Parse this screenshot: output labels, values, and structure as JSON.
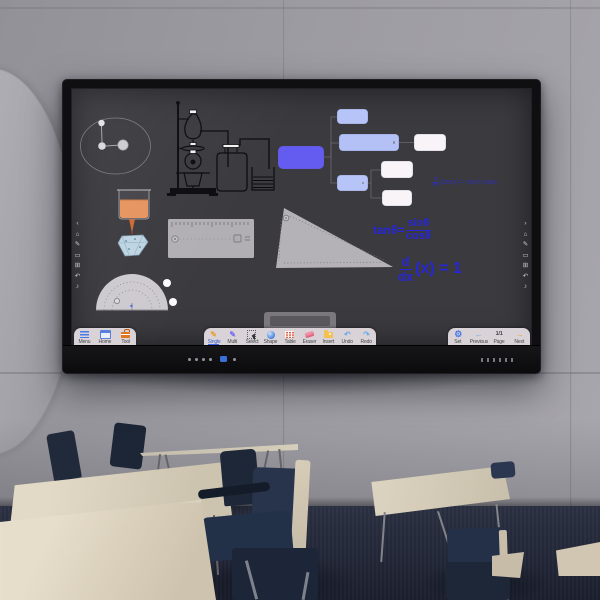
{
  "whiteboard": {
    "formulas": {
      "sec_derivative": {
        "num": "d",
        "den": "dx",
        "body": "(secx) = secx·tanx"
      },
      "tan_identity": {
        "lhs": "tanθ=",
        "num": "sinθ",
        "den": "cosθ"
      },
      "x_derivative": {
        "num": "d",
        "den": "dx",
        "body": "(x) = 1"
      }
    },
    "icon_glyphs": {
      "pen": "✎",
      "undo": "↶",
      "redo": "↷",
      "gear": "⚙",
      "arrow_left": "←",
      "arrow_right": "→"
    },
    "side_toolbar": {
      "left": [
        "‹",
        "⌂",
        "✎",
        "▭",
        "⊞",
        "↶",
        "♪"
      ],
      "right": [
        "›",
        "⌂",
        "✎",
        "▭",
        "⊞",
        "↶",
        "♪"
      ]
    },
    "docks": {
      "left": [
        {
          "label": "Menu",
          "icon": "hamburger-menu-icon"
        },
        {
          "label": "Home",
          "icon": "home-window-icon"
        },
        {
          "label": "Tool",
          "icon": "toolbox-icon"
        }
      ],
      "center": [
        {
          "label": "Single",
          "icon": "single-pen-icon",
          "selected": true
        },
        {
          "label": "Multi",
          "icon": "multi-pen-icon"
        },
        {
          "label": "Select",
          "icon": "select-cursor-icon"
        },
        {
          "label": "Shape",
          "icon": "shape-circle-icon"
        },
        {
          "label": "Table",
          "icon": "table-grid-icon"
        },
        {
          "label": "Eraser",
          "icon": "eraser-icon"
        },
        {
          "label": "Insert",
          "icon": "insert-folder-icon"
        },
        {
          "label": "Undo",
          "icon": "undo-arrow-icon"
        },
        {
          "label": "Redo",
          "icon": "redo-arrow-icon"
        }
      ],
      "right": [
        {
          "label": "Set",
          "icon": "settings-gear-icon"
        },
        {
          "label": "Previous",
          "icon": "previous-arrow-icon"
        },
        {
          "label": "Page",
          "icon": "page-indicator",
          "value": "1/1"
        },
        {
          "label": "Next",
          "icon": "next-arrow-icon"
        }
      ]
    },
    "colors": {
      "ink_blue": "#2626d6",
      "node_blue": "#645cf0",
      "node_light_blue": "#b5c2f7",
      "node_white": "#f8f4f7",
      "dock_bg": "#d9d3d7",
      "liquid_orange": "#e5945e"
    }
  }
}
